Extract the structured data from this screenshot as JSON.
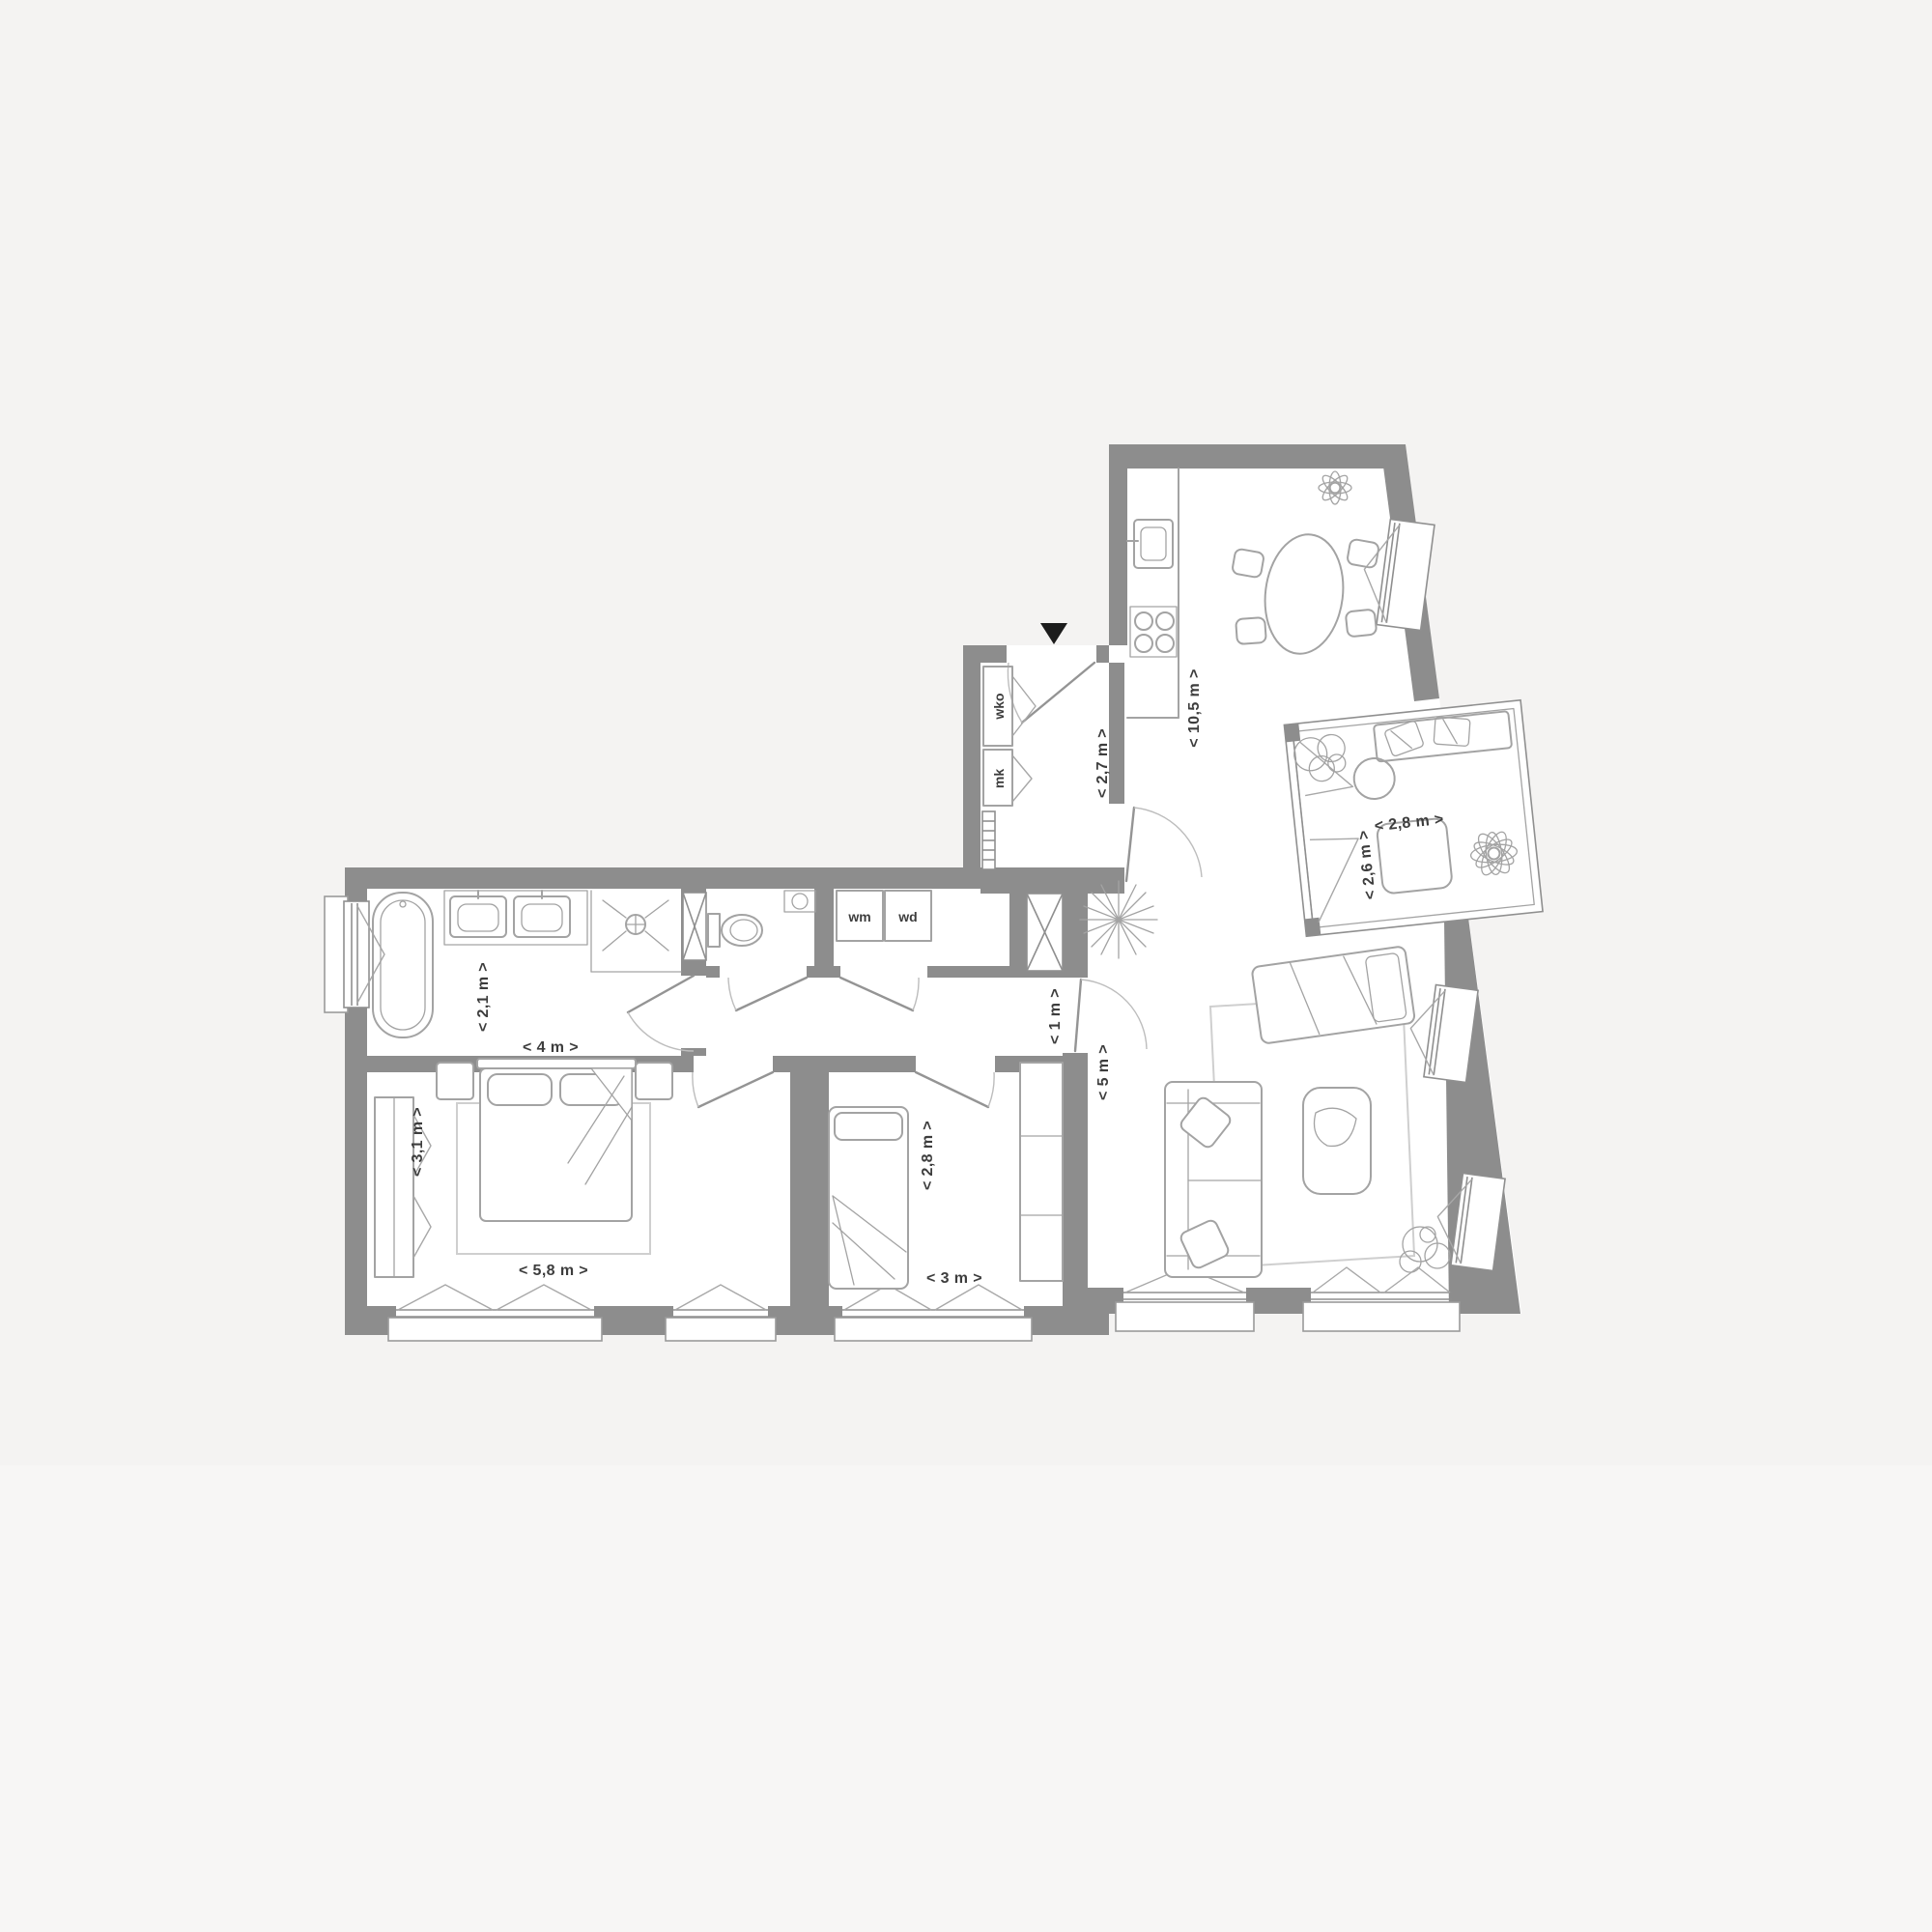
{
  "page": {
    "background": "#f4f3f2",
    "bottom_band": "#f7f6f5"
  },
  "plan": {
    "type": "apartment-floor-plan",
    "colors": {
      "wall": "#8d8d8d",
      "fur": "#a3a3a3",
      "frame": "#8f8f8f",
      "label": "#3d3d3d",
      "arrow": "#1c1c1c",
      "bg": "#f4f3f2",
      "band": "#f7f6f5",
      "rug": "#cfcfcf"
    },
    "labels": {
      "bathroom_depth": "< 2,1 m >",
      "bathroom_width": "< 4 m >",
      "bedroom1_depth": "< 3,1 m >",
      "bedroom1_width": "< 5,8 m >",
      "bedroom2_depth": "< 2,8 m >",
      "bedroom2_width": "< 3 m >",
      "corridor_width": "< 1 m >",
      "living_width": "< 5 m >",
      "hall_depth": "< 2,7 m >",
      "kitchen_living_length": "< 10,5 m >",
      "balcony_width": "< 2,8 m >",
      "balcony_depth": "< 2,6 m >",
      "closet_top": "wko",
      "closet_bottom": "mk",
      "washer": "wm",
      "dryer": "wd"
    }
  }
}
